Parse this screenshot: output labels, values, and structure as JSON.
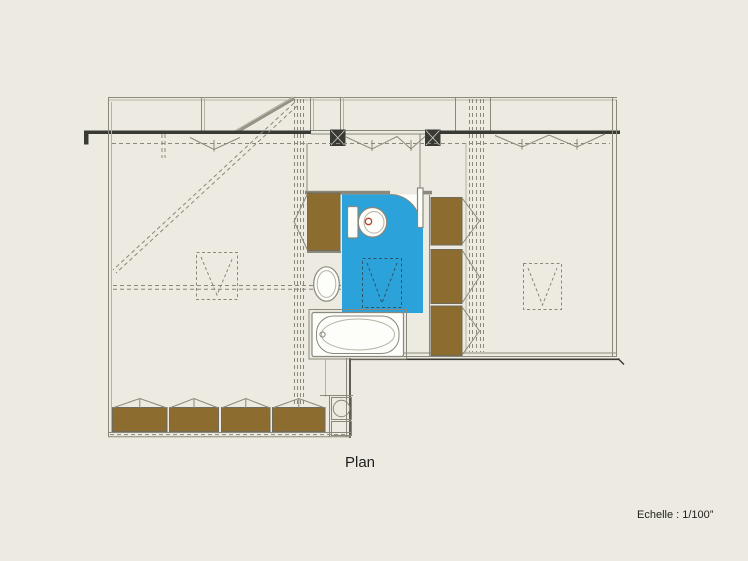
{
  "labels": {
    "plan": "Plan",
    "scale": "Echelle : 1/100”"
  },
  "colors": {
    "background": "#edebe1",
    "wall": "#8a877b",
    "wall_light": "#b5b2a4",
    "dark": "#3a3a35",
    "blue": "#2ba3da",
    "brown": "#8d6c2f",
    "white": "#fdfdfa",
    "red": "#b5452e",
    "text": "#1e1e1c"
  }
}
